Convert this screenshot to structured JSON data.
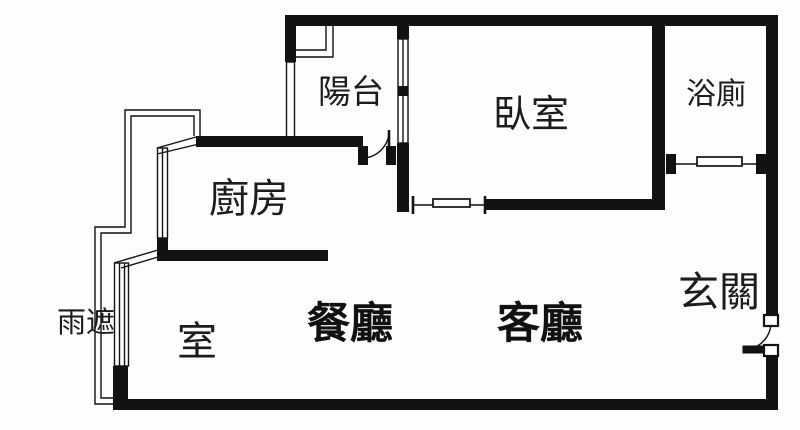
{
  "plan": {
    "type": "apartment-floor-plan",
    "colors": {
      "background": "#fdfdfd",
      "line": "#121212",
      "text": "#1c1c1c"
    },
    "rooms": [
      {
        "id": "balcony",
        "label": "陽台"
      },
      {
        "id": "bedroom",
        "label": "臥室"
      },
      {
        "id": "bathroom",
        "label": "浴廁"
      },
      {
        "id": "kitchen",
        "label": "廚房"
      },
      {
        "id": "rain-cover",
        "label": "雨遮"
      },
      {
        "id": "room",
        "label": "室"
      },
      {
        "id": "dining-room",
        "label": "餐廳"
      },
      {
        "id": "living-room",
        "label": "客廳"
      },
      {
        "id": "entryway",
        "label": "玄關"
      }
    ],
    "features": [
      "entrance-swing-door",
      "balcony-swing-door",
      "bedroom-sliding-door",
      "bathroom-sliding-door",
      "balcony-window",
      "kitchen-window",
      "room-window",
      "rain-cover-outline"
    ]
  }
}
